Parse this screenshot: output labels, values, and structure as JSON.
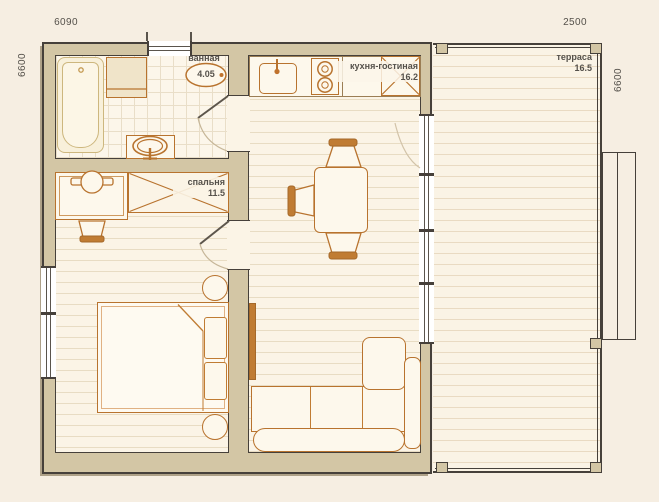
{
  "plan": {
    "rooms": [
      {
        "name": "ванная",
        "area": "4.05"
      },
      {
        "name": "кухня-гостиная",
        "area": "16.2"
      },
      {
        "name": "спальня",
        "area": "11.5"
      },
      {
        "name": "терраса",
        "area": "16.5"
      }
    ],
    "dimensions": {
      "top_left": "6090",
      "top_right": "2500",
      "side_left": "6600",
      "side_right": "6600"
    },
    "colors": {
      "background": "#f6eee2",
      "wall_fill": "#d3c6a5",
      "wall_line": "#46403a",
      "floor": "#fbf4e6",
      "furniture_accent": "#b8732e",
      "label_text": "#55514b"
    }
  }
}
